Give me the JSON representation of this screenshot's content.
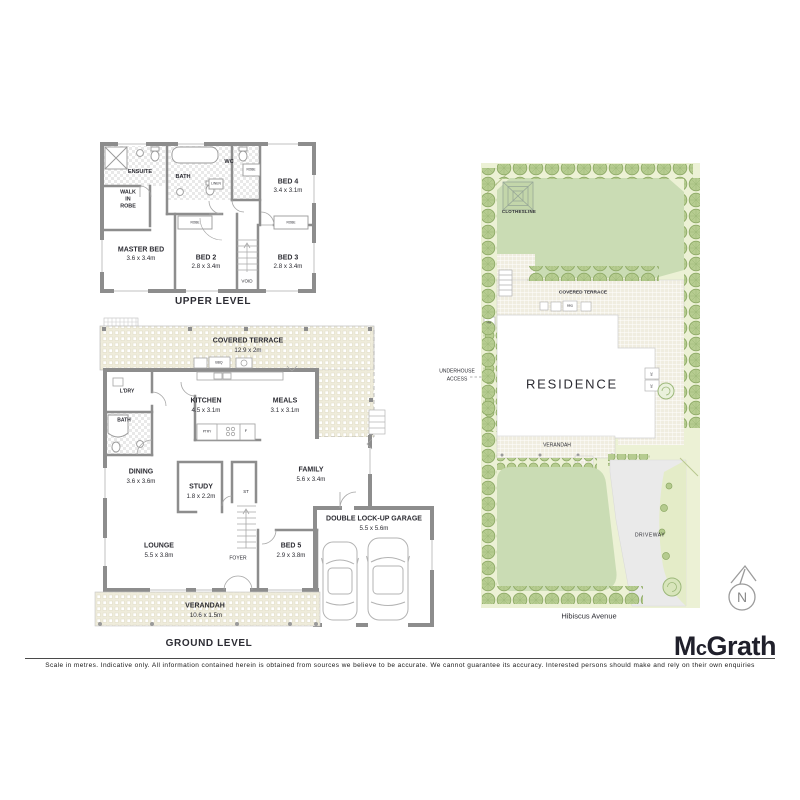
{
  "upper_level": {
    "labels": [
      {
        "name": "room-label-ensuite",
        "text": "ENSUITE",
        "x": 140,
        "y": 173,
        "fs": 5.6,
        "b": 1
      },
      {
        "name": "room-label-bath-upper",
        "text": "BATH",
        "x": 183,
        "y": 178,
        "fs": 5.6,
        "b": 1
      },
      {
        "name": "room-label-wc",
        "text": "WC",
        "x": 229,
        "y": 163,
        "fs": 5.6,
        "b": 1
      },
      {
        "name": "label-linen",
        "text": "LINEN",
        "x": 216,
        "y": 184,
        "fs": 3.3
      },
      {
        "name": "label-robe-wc",
        "text": "ROBE",
        "x": 251,
        "y": 170,
        "fs": 3.2
      },
      {
        "name": "room-label-bed4",
        "text": "BED 4",
        "x": 288,
        "y": 182,
        "fs": 7,
        "b": 1
      },
      {
        "name": "dim-bed4",
        "text": "3.4 x 3.1m",
        "x": 288,
        "y": 191,
        "fs": 6.2
      },
      {
        "name": "label-walk",
        "text": "WALK",
        "x": 128,
        "y": 193,
        "fs": 5.4,
        "b": 1
      },
      {
        "name": "label-in",
        "text": "IN",
        "x": 128,
        "y": 200,
        "fs": 5.4,
        "b": 1
      },
      {
        "name": "label-robe-wir",
        "text": "ROBE",
        "x": 128,
        "y": 207,
        "fs": 5.4,
        "b": 1
      },
      {
        "name": "room-label-master-bed",
        "text": "MASTER BED",
        "x": 141,
        "y": 250,
        "fs": 7,
        "b": 1
      },
      {
        "name": "dim-master-bed",
        "text": "3.6 x 3.4m",
        "x": 141,
        "y": 259,
        "fs": 6.2
      },
      {
        "name": "label-robe-bed2",
        "text": "ROBE",
        "x": 195,
        "y": 223,
        "fs": 3.2
      },
      {
        "name": "label-robe-bed3",
        "text": "ROBE",
        "x": 291,
        "y": 223,
        "fs": 3.2
      },
      {
        "name": "room-label-bed2",
        "text": "BED 2",
        "x": 206,
        "y": 258,
        "fs": 7,
        "b": 1
      },
      {
        "name": "dim-bed2",
        "text": "2.8 x 3.4m",
        "x": 206,
        "y": 267,
        "fs": 6.2
      },
      {
        "name": "room-label-bed3",
        "text": "BED 3",
        "x": 288,
        "y": 258,
        "fs": 7,
        "b": 1
      },
      {
        "name": "dim-bed3",
        "text": "2.8 x 3.4m",
        "x": 288,
        "y": 267,
        "fs": 6.2
      },
      {
        "name": "label-void",
        "text": "VOID",
        "x": 247,
        "y": 282,
        "fs": 4.6
      },
      {
        "name": "upper-level-title",
        "text": "UPPER LEVEL",
        "x": 213,
        "y": 302,
        "fs": 10,
        "b": 1,
        "ls": 0.6
      }
    ]
  },
  "ground_level": {
    "labels": [
      {
        "name": "room-label-covered-terrace",
        "text": "COVERED TERRACE",
        "x": 248,
        "y": 341,
        "fs": 7,
        "b": 1
      },
      {
        "name": "dim-covered-terrace",
        "text": "12.9 x 2m",
        "x": 248,
        "y": 351,
        "fs": 6.2
      },
      {
        "name": "label-bbq",
        "text": "BBQ",
        "x": 219,
        "y": 363,
        "fs": 3.4
      },
      {
        "name": "room-label-ldry",
        "text": "L'DRY",
        "x": 127,
        "y": 392,
        "fs": 5,
        "b": 1
      },
      {
        "name": "room-label-bath-ground",
        "text": "BATH",
        "x": 124,
        "y": 421,
        "fs": 5,
        "b": 1
      },
      {
        "name": "room-label-kitchen",
        "text": "KITCHEN",
        "x": 206,
        "y": 401,
        "fs": 7,
        "b": 1
      },
      {
        "name": "dim-kitchen",
        "text": "4.5 x 3.1m",
        "x": 206,
        "y": 411,
        "fs": 6.2
      },
      {
        "name": "room-label-meals",
        "text": "MEALS",
        "x": 285,
        "y": 401,
        "fs": 7,
        "b": 1
      },
      {
        "name": "dim-meals",
        "text": "3.1 x 3.1m",
        "x": 285,
        "y": 411,
        "fs": 6.2
      },
      {
        "name": "label-ptry",
        "text": "PTRY",
        "x": 207,
        "y": 432,
        "fs": 3.2
      },
      {
        "name": "label-fridge",
        "text": "F",
        "x": 246,
        "y": 431,
        "fs": 4
      },
      {
        "name": "room-label-dining",
        "text": "DINING",
        "x": 141,
        "y": 472,
        "fs": 7,
        "b": 1
      },
      {
        "name": "dim-dining",
        "text": "3.6 x 3.6m",
        "x": 141,
        "y": 482,
        "fs": 6.2
      },
      {
        "name": "room-label-study",
        "text": "STUDY",
        "x": 201,
        "y": 487,
        "fs": 7,
        "b": 1
      },
      {
        "name": "dim-study",
        "text": "1.8 x 2.2m",
        "x": 201,
        "y": 497,
        "fs": 6.2
      },
      {
        "name": "label-st",
        "text": "ST",
        "x": 246,
        "y": 492,
        "fs": 4.4
      },
      {
        "name": "room-label-family",
        "text": "FAMILY",
        "x": 311,
        "y": 470,
        "fs": 7,
        "b": 1
      },
      {
        "name": "dim-family",
        "text": "5.6 x 3.4m",
        "x": 311,
        "y": 480,
        "fs": 6.2
      },
      {
        "name": "room-label-lounge",
        "text": "LOUNGE",
        "x": 159,
        "y": 546,
        "fs": 7,
        "b": 1
      },
      {
        "name": "dim-lounge",
        "text": "5.5 x 3.8m",
        "x": 159,
        "y": 556,
        "fs": 6.2
      },
      {
        "name": "label-foyer",
        "text": "FOYER",
        "x": 238,
        "y": 559,
        "fs": 5
      },
      {
        "name": "room-label-bed5",
        "text": "BED 5",
        "x": 291,
        "y": 546,
        "fs": 7,
        "b": 1
      },
      {
        "name": "dim-bed5",
        "text": "2.9 x 3.8m",
        "x": 291,
        "y": 556,
        "fs": 6.2
      },
      {
        "name": "room-label-garage",
        "text": "DOUBLE LOCK-UP GARAGE",
        "x": 374,
        "y": 519,
        "fs": 7,
        "b": 1
      },
      {
        "name": "dim-garage",
        "text": "5.5 x 5.6m",
        "x": 374,
        "y": 529,
        "fs": 6.2
      },
      {
        "name": "room-label-verandah",
        "text": "VERANDAH",
        "x": 205,
        "y": 606,
        "fs": 7,
        "b": 1
      },
      {
        "name": "dim-verandah",
        "text": "10.6 x 1.5m",
        "x": 206,
        "y": 616,
        "fs": 6.2
      },
      {
        "name": "ground-level-title",
        "text": "GROUND LEVEL",
        "x": 209,
        "y": 644,
        "fs": 10,
        "b": 1,
        "ls": 0.6
      }
    ]
  },
  "site_plan": {
    "labels": [
      {
        "name": "label-clothesline",
        "text": "CLOTHESLINE",
        "x": 519,
        "y": 212,
        "fs": 4.4,
        "b": 1,
        "ls": 0.3
      },
      {
        "name": "label-covered-terrace-site",
        "text": "COVERED TERRACE",
        "x": 583,
        "y": 294,
        "fs": 4.8,
        "b": 1
      },
      {
        "name": "label-bbq-site",
        "text": "BBQ",
        "x": 570,
        "y": 306,
        "fs": 2.8
      },
      {
        "name": "label-hw",
        "text": "HW",
        "x": 489,
        "y": 323,
        "fs": 2.8
      },
      {
        "name": "label-underhouse-1",
        "text": "UNDERHOUSE",
        "x": 457,
        "y": 372,
        "fs": 5
      },
      {
        "name": "label-underhouse-2",
        "text": "ACCESS",
        "x": 457,
        "y": 380,
        "fs": 5
      },
      {
        "name": "label-residence",
        "text": "RESIDENCE",
        "x": 572,
        "y": 384,
        "fs": 13,
        "ls": 1.8
      },
      {
        "name": "label-ac-1",
        "text": "AC",
        "x": 652,
        "y": 374,
        "fs": 2.8,
        "rot": -90
      },
      {
        "name": "label-ac-2",
        "text": "AC",
        "x": 652,
        "y": 386,
        "fs": 2.8,
        "rot": -90
      },
      {
        "name": "label-verandah-site",
        "text": "VERANDAH",
        "x": 557,
        "y": 446,
        "fs": 5
      },
      {
        "name": "label-driveway",
        "text": "DRIVEWAY",
        "x": 650,
        "y": 536,
        "fs": 5,
        "ls": 0.5
      },
      {
        "name": "label-street",
        "text": "Hibiscus Avenue",
        "x": 589,
        "y": 616,
        "fs": 7.5
      }
    ]
  },
  "north_arrow": {
    "letter": "N"
  },
  "branding": {
    "logo_m": "M",
    "logo_c": "c",
    "logo_rest": "Grath"
  },
  "footer": {
    "disclaimer": "Scale in metres. Indicative only. All information contained herein is obtained from sources we believe to be accurate. We cannot guarantee its accuracy. Interested persons should make and rely on their own enquiries"
  }
}
